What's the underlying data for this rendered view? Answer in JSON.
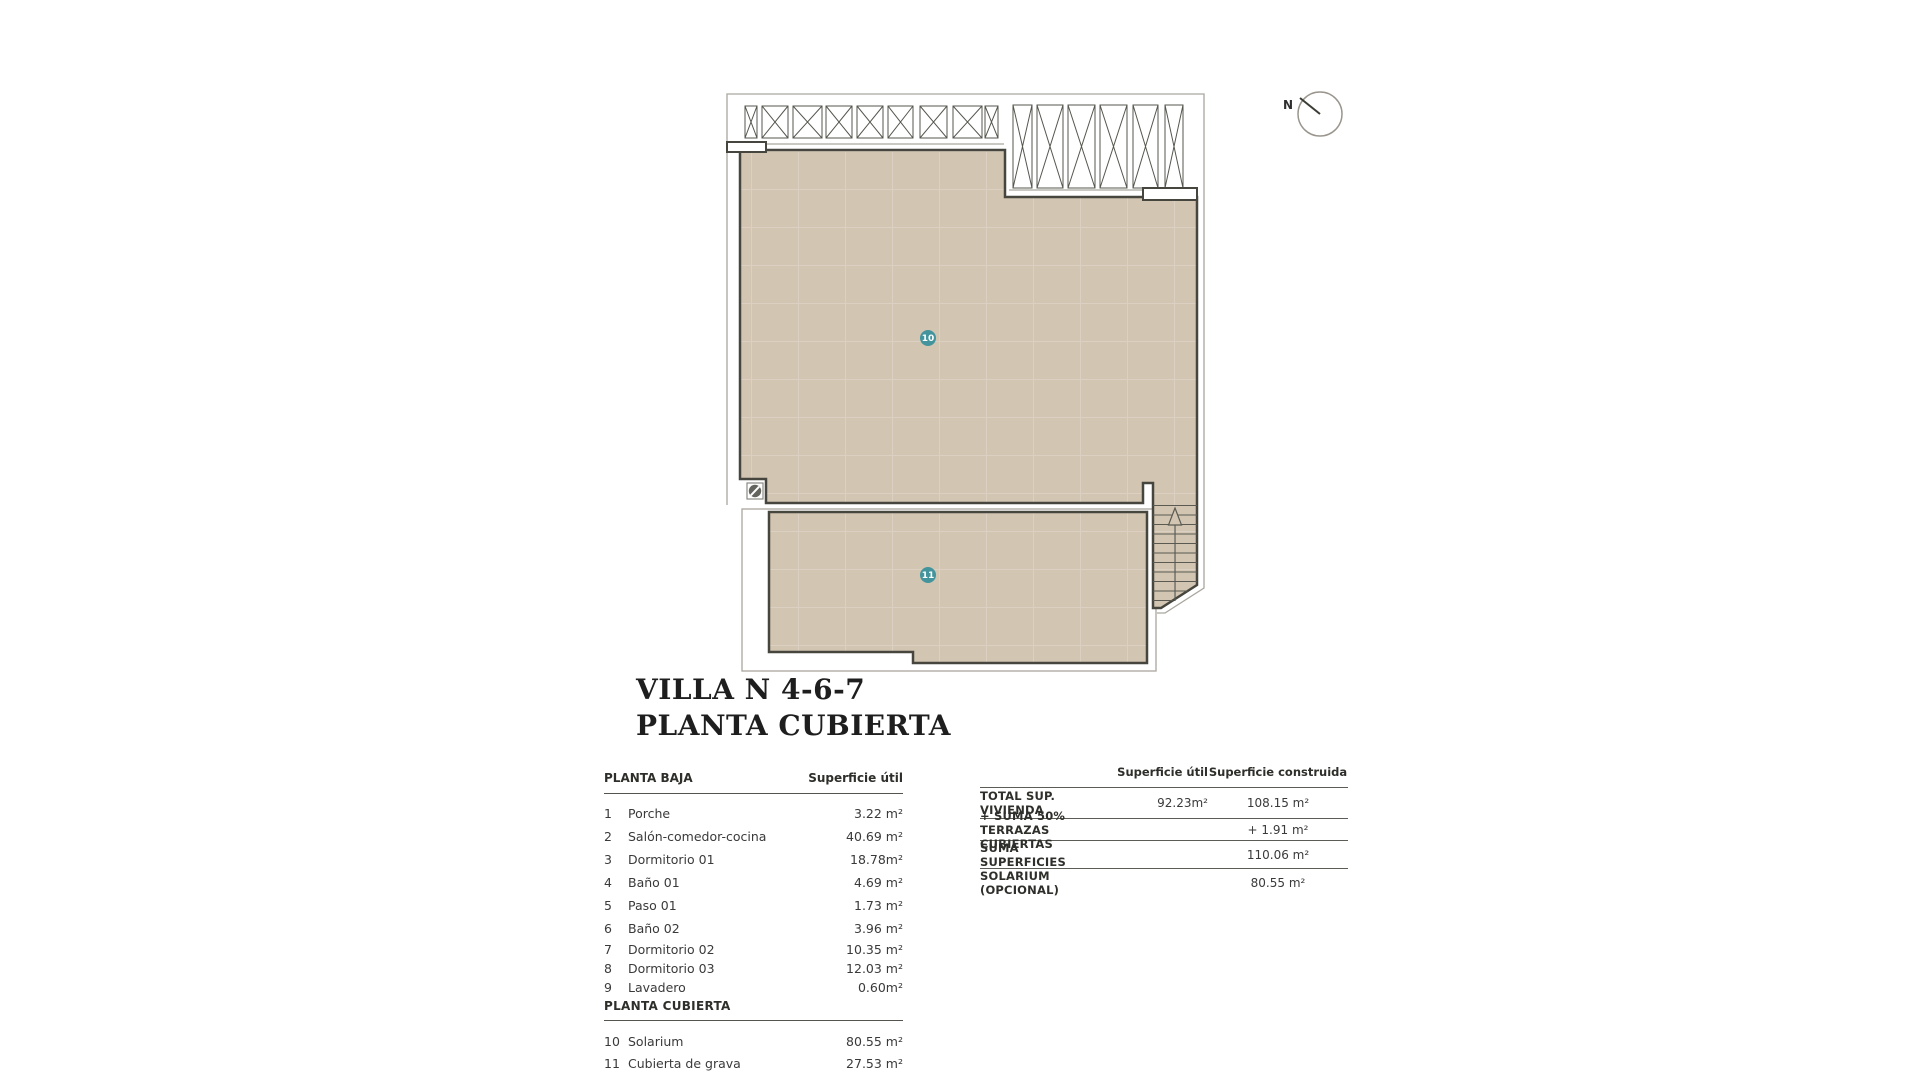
{
  "title": {
    "line1": "VILLA N 4-6-7",
    "line2": "PLANTA CUBIERTA"
  },
  "plan": {
    "marker_10": "10",
    "marker_11": "11",
    "north_label": "N"
  },
  "left_table": {
    "section1_header": "PLANTA BAJA",
    "col_header": "Superficie útil",
    "rows": [
      {
        "num": "1",
        "label": "Porche",
        "value": "3.22 m²"
      },
      {
        "num": "2",
        "label": "Salón-comedor-cocina",
        "value": "40.69 m²"
      },
      {
        "num": "3",
        "label": "Dormitorio 01",
        "value": "18.78m²"
      },
      {
        "num": "4",
        "label": "Baño 01",
        "value": "4.69 m²"
      },
      {
        "num": "5",
        "label": "Paso 01",
        "value": "1.73 m²"
      },
      {
        "num": "6",
        "label": "Baño 02",
        "value": "3.96 m²"
      },
      {
        "num": "7",
        "label": "Dormitorio 02",
        "value": "10.35 m²"
      },
      {
        "num": "8",
        "label": "Dormitorio 03",
        "value": "12.03 m²"
      },
      {
        "num": "9",
        "label": "Lavadero",
        "value": "0.60m²"
      }
    ],
    "section2_header": "PLANTA CUBIERTA",
    "rows2": [
      {
        "num": "10",
        "label": "Solarium",
        "value": "80.55 m²"
      },
      {
        "num": "11",
        "label": "Cubierta de grava",
        "value": "27.53 m²"
      }
    ]
  },
  "right_table": {
    "col1_header": "Superficie útil",
    "col2_header": "Superficie construida",
    "rows": [
      {
        "label": "TOTAL SUP. VIVIENDA",
        "util": "92.23m²",
        "constr": "108.15 m²"
      },
      {
        "label": "+ SUMA 50% TERRAZAS CUBIERTAS",
        "util": "",
        "constr": "+ 1.91 m²"
      },
      {
        "label": "SUMA SUPERFICIES",
        "util": "",
        "constr": "110.06 m²"
      },
      {
        "label": "SOLARIUM (OPCIONAL)",
        "util": "",
        "constr": "80.55 m²"
      }
    ]
  },
  "colors": {
    "beige": "#d2c5b2",
    "grid_line": "#dbd0c1",
    "wall": "#46463f",
    "thin_line": "#aaa69e",
    "pergola_line": "#56564f",
    "teal": "#43949c"
  }
}
